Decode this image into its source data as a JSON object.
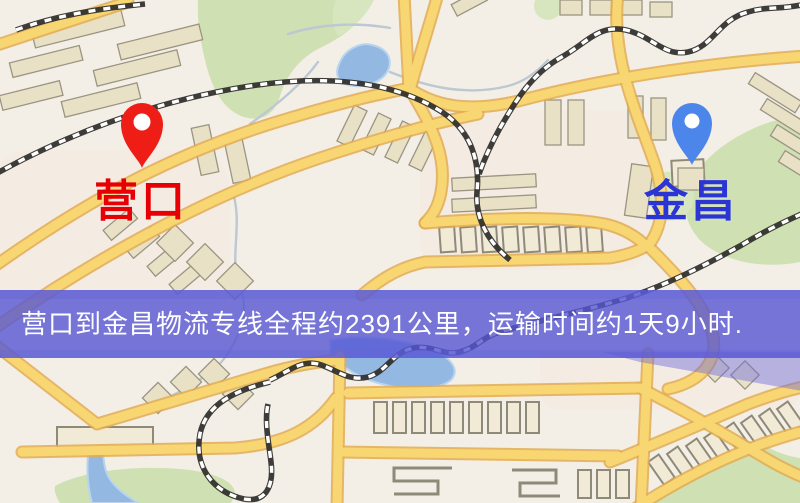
{
  "banner": {
    "text": "营口到金昌物流专线全程约2391公里，运输时间约1天9小时."
  },
  "markers": {
    "origin": {
      "label": "营口"
    },
    "destination": {
      "label": "金昌"
    }
  },
  "colors": {
    "origin_pin": "#ee1d15",
    "origin_label": "#e60005",
    "destination_pin": "#4d86ea",
    "destination_label": "#2a35d4",
    "banner_bg": "rgba(86,86,211,0.80)",
    "banner_halo": "rgba(100,100,218,0.35)",
    "banner_text": "#ffffff",
    "road_fill": "#f8d671",
    "water": "#93b9e3",
    "park": "#cfe0b2"
  }
}
